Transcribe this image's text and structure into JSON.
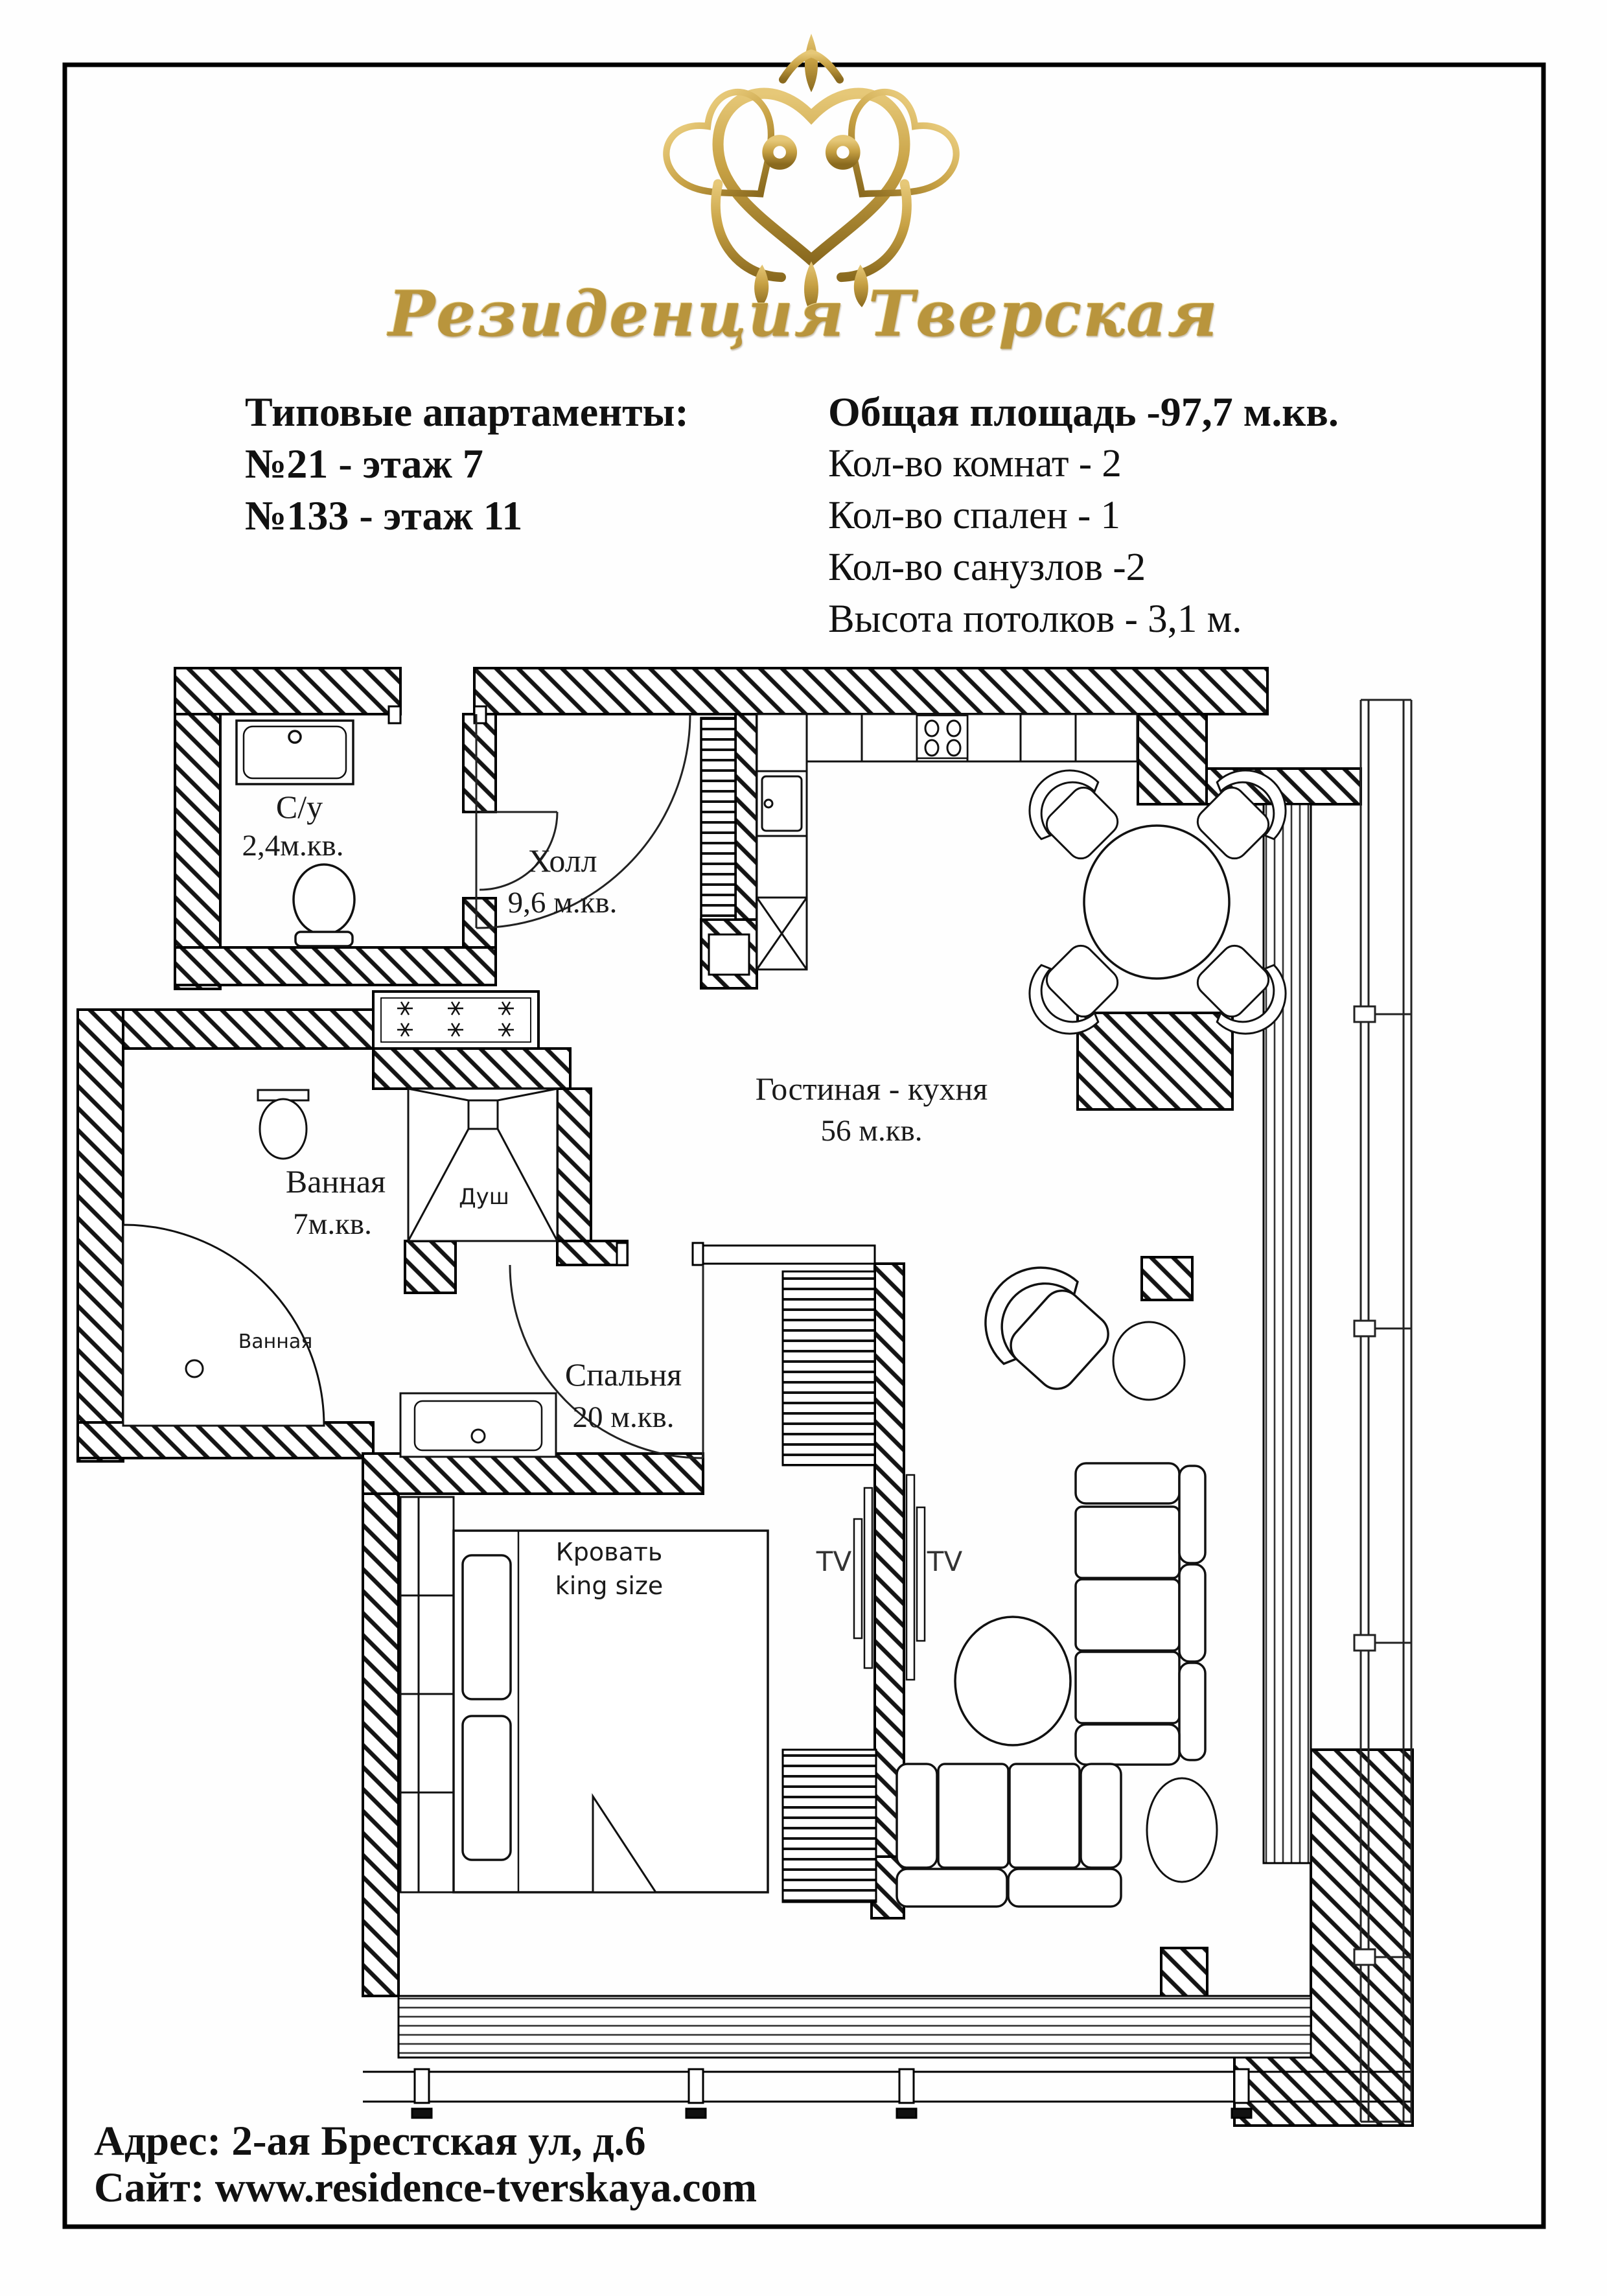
{
  "logo": {
    "brand": "Резиденция Тверская",
    "crown_icon": "gold-ornamental-crown",
    "accent_gold": "#b9953d"
  },
  "header": {
    "left": {
      "title": "Типовые апартаменты:",
      "lines": [
        "№21 - этаж 7",
        "№133 - этаж 11"
      ]
    },
    "right": {
      "title": "Общая площадь -97,7 м.кв.",
      "lines": [
        "Кол-во комнат - 2",
        "Кол-во спален - 1",
        "Кол-во санузлов -2",
        "Высота потолков - 3,1 м."
      ]
    }
  },
  "plan": {
    "wc": {
      "name": "С/у",
      "area": "2,4м.кв."
    },
    "hall": {
      "name": "Холл",
      "area": "9,6 м.кв."
    },
    "living": {
      "name": "Гостиная - кухня",
      "area": "56 м.кв."
    },
    "bath": {
      "name": "Ванная",
      "area": "7м.кв."
    },
    "bedroom": {
      "name": "Спальня",
      "area": "20 м.кв."
    },
    "shower_label": "Душ",
    "tub_label": "Ванная",
    "bed": {
      "line1": "Кровать",
      "line2": "king  size"
    },
    "tv": [
      "TV",
      "TV"
    ]
  },
  "footer": {
    "address": "Адрес: 2-ая Брестская ул, д.6",
    "website": "Сайт: www.residence-tverskaya.com"
  }
}
